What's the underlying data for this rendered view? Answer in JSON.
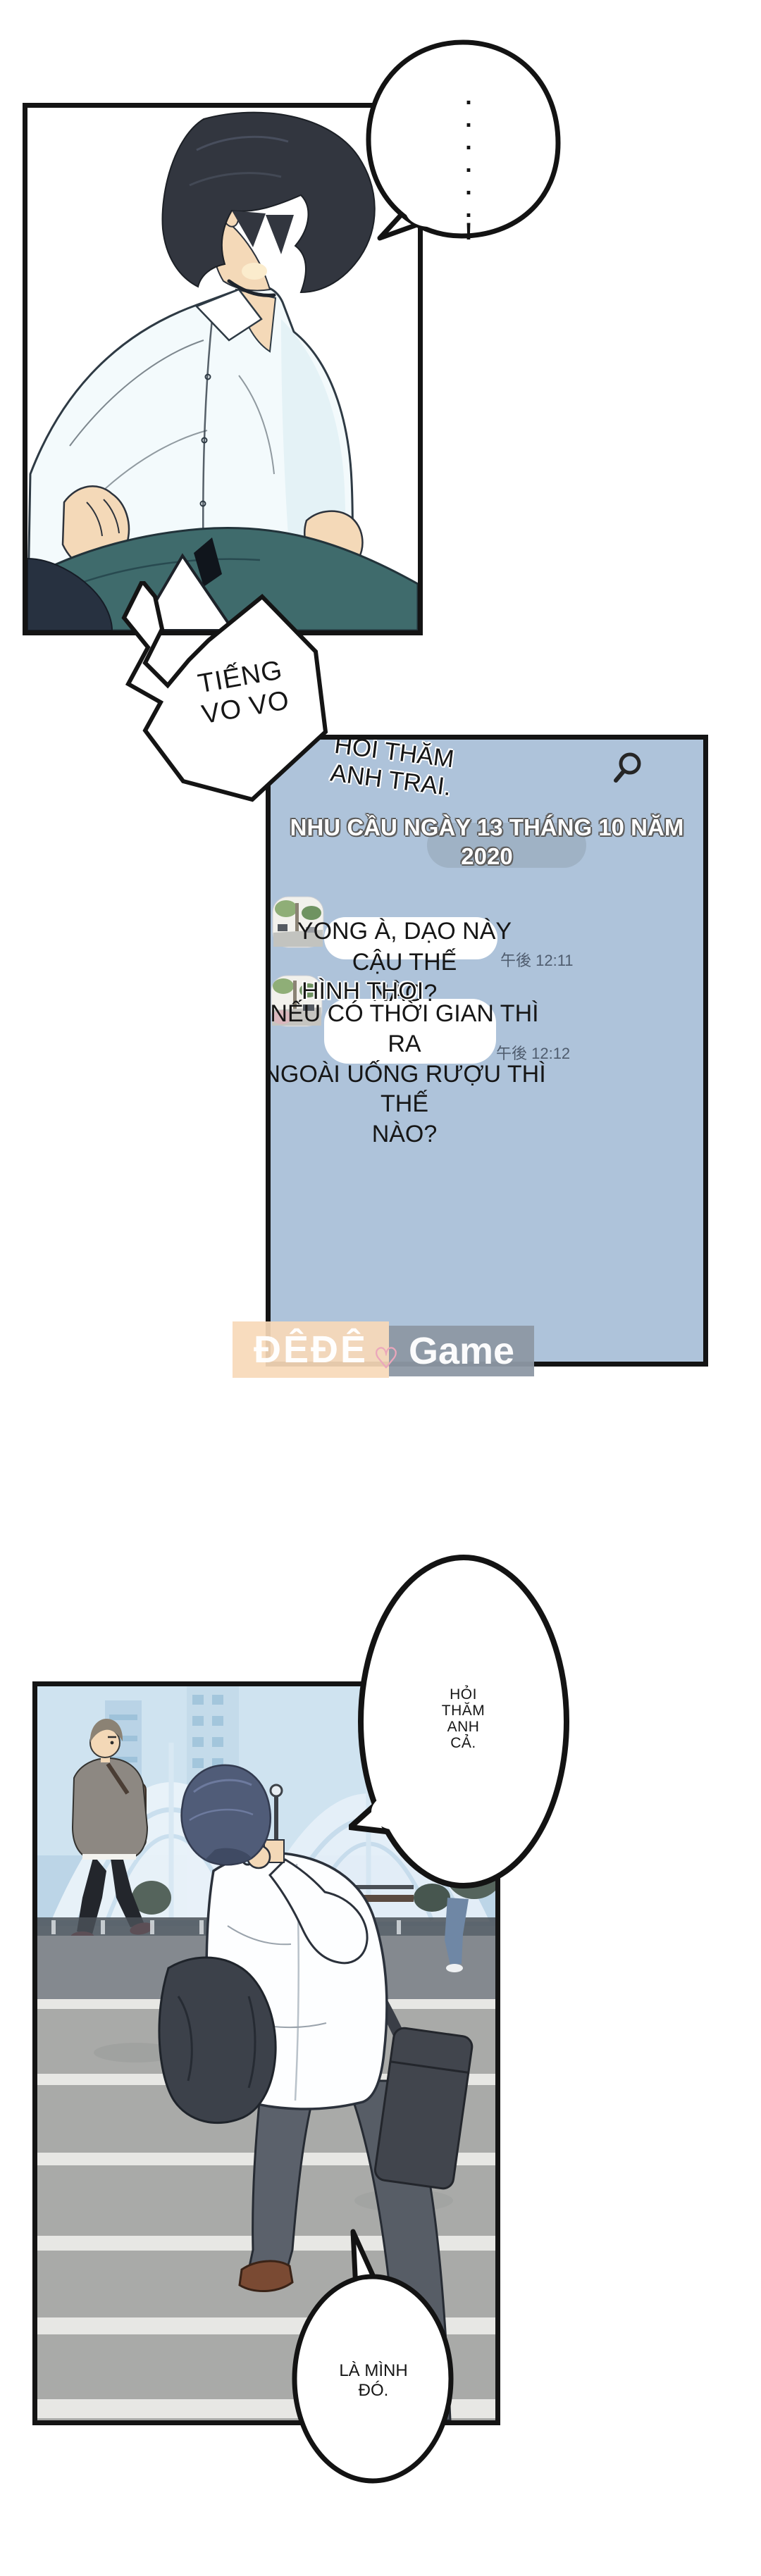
{
  "meta": {
    "type": "webtoon-comic-page",
    "language": "Vietnamese",
    "colors": {
      "panel_border": "#141414",
      "chat_bg": "#aec3da",
      "chat_bubble": "#ffffff",
      "timestamp": "#4f5c6e",
      "date_pill": "#9db0c2",
      "watermark_peach": "#f7d9b8",
      "watermark_gray": "#8d98a4",
      "watermark_heart": "#eba6bb",
      "pants_teal": "#3f6b6c",
      "sky": "#cfe3f0",
      "crosswalk_gray": "#a9aaa8",
      "crosswalk_stripe": "#e7e7e4"
    }
  },
  "bubbles": {
    "silence": {
      "text": "......!"
    },
    "sfx": {
      "line1": "TIẾNG",
      "line2": "VO VO"
    },
    "ask_brother": {
      "lines": [
        "HỎI",
        "THĂM",
        "ANH",
        "CẢ."
      ]
    },
    "its_me": {
      "lines": [
        "LÀ MÌNH",
        "ĐÓ."
      ]
    }
  },
  "chat": {
    "header_line1": "HỎI THĂM",
    "header_line2": "ANH TRAI.",
    "search_icon": "magnifier",
    "date_banner": {
      "line1": "NHU CẦU NGÀY 13 THÁNG 10 NĂM",
      "line2": "2020"
    },
    "messages": [
      {
        "avatar": "street-photo",
        "lines": [
          "YONG À, DẠO NÀY CẬU THẾ",
          "NÀO?"
        ],
        "time": "午後 12:11"
      },
      {
        "avatar": "street-photo",
        "sender": "HÌNH THOI",
        "lines": [
          "NẾU CÓ THỜI GIAN THÌ RA",
          "NGOÀI UỐNG RƯỢU THÌ THẾ",
          "NÀO?"
        ],
        "time": "午後 12:12"
      }
    ]
  },
  "watermark": {
    "left": "ĐÊĐÊ",
    "heart": "♡",
    "right": "Game"
  }
}
